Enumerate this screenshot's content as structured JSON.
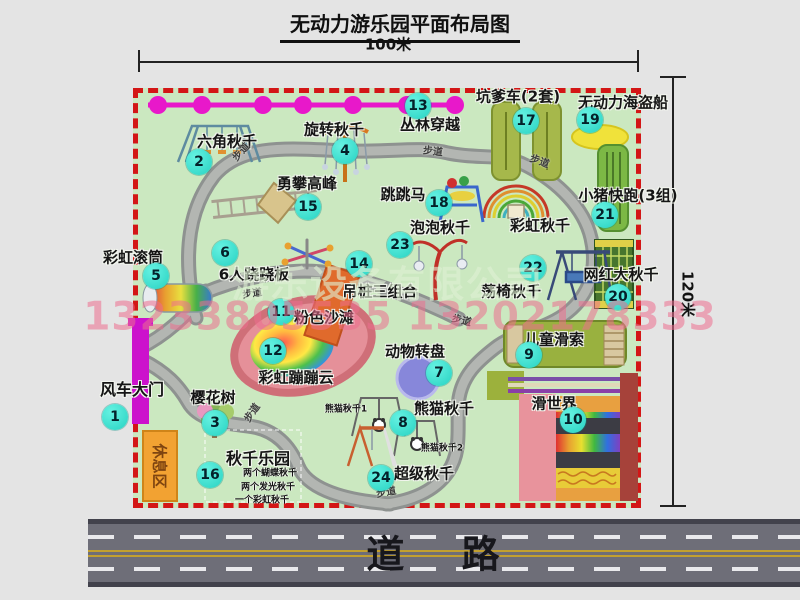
{
  "title": "无动力游乐园平面布局图",
  "dimensions": {
    "width_label": "100米",
    "height_label": "120米"
  },
  "road_label": "道 路",
  "path_label": "步道",
  "rest_area_label": "休息区",
  "rainbow_swing_label": "彩虹秋千",
  "watermark": {
    "company": "游乐设备有限公司",
    "phones": "13233805535 13202178333"
  },
  "colors": {
    "map_green": "#cbe8c0",
    "border_red": "#d31616",
    "badge_cyan": "#2ed5c5",
    "zipline_magenta": "#e818ca",
    "gate_magenta": "#cc12cc",
    "rest_orange": "#f2a232",
    "road_gray": "#6e6e78",
    "path_gray": "#aeb2ae"
  },
  "attractions": [
    {
      "num": "1",
      "label": "风车大门"
    },
    {
      "num": "2",
      "label": "六角秋千"
    },
    {
      "num": "3",
      "label": "樱花树"
    },
    {
      "num": "4",
      "label": "旋转秋千"
    },
    {
      "num": "5",
      "label": "彩虹滚筒"
    },
    {
      "num": "6",
      "label": "6人跷跷板"
    },
    {
      "num": "7",
      "label": "动物转盘"
    },
    {
      "num": "8",
      "label": "熊猫秋千",
      "sub1": "熊猫秋千1",
      "sub2": "熊猫秋千2"
    },
    {
      "num": "9",
      "label": "儿童滑索"
    },
    {
      "num": "10",
      "label": "滑世界"
    },
    {
      "num": "11",
      "label": "粉色沙滩"
    },
    {
      "num": "12",
      "label": "彩虹蹦蹦云"
    },
    {
      "num": "13",
      "label": "丛林穿越"
    },
    {
      "num": "14",
      "label": "吊桩三组合"
    },
    {
      "num": "15",
      "label": "勇攀高峰"
    },
    {
      "num": "16",
      "label": "秋千乐园",
      "subs": [
        "两个蝴蝶秋千",
        "两个发光秋千",
        "一个彩虹秋千"
      ]
    },
    {
      "num": "17",
      "label": "坑爹车(2套)"
    },
    {
      "num": "18",
      "label": "跳跳马"
    },
    {
      "num": "19",
      "label": "无动力海盗船"
    },
    {
      "num": "20",
      "label": "网红大秋千"
    },
    {
      "num": "21",
      "label": "小猪快跑(3组)"
    },
    {
      "num": "22",
      "label": "荡椅秋千"
    },
    {
      "num": "23",
      "label": "泡泡秋千"
    },
    {
      "num": "24",
      "label": "超级秋千"
    }
  ]
}
